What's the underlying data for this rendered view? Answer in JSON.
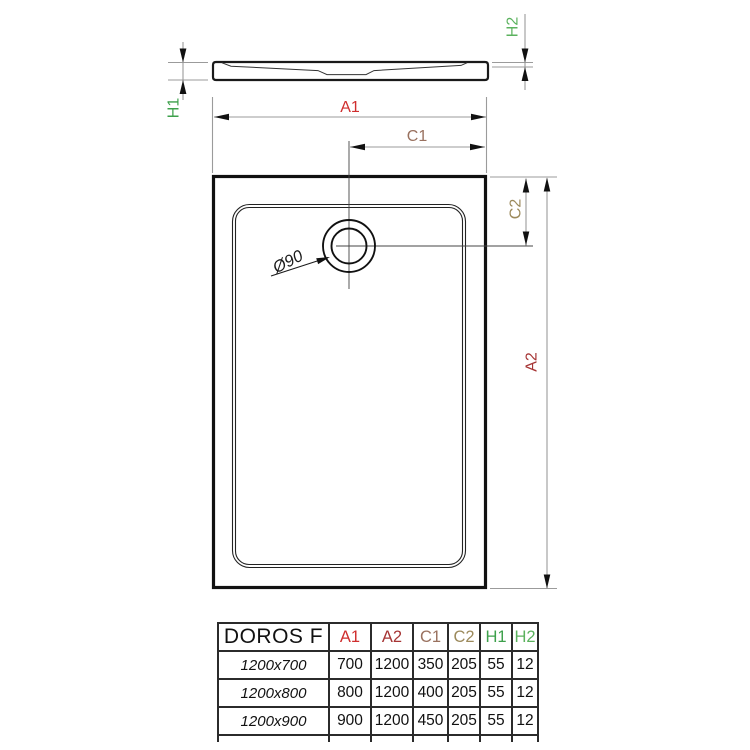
{
  "diagram": {
    "labels": {
      "a1": "A1",
      "a2": "A2",
      "c1": "C1",
      "c2": "C2",
      "h1": "H1",
      "h2": "H2",
      "drain_diameter": "Ø90"
    }
  },
  "colors": {
    "a1_red": "#cf2e2e",
    "a2_dark_red": "#a63535",
    "c1_brown": "#99715f",
    "c2_olive_brown": "#9c8a5c",
    "h1_green": "#3da04b",
    "h2_green": "#5bb25e",
    "drawing_line": "#1a1a1a",
    "dimension_gray": "#9b9b9b",
    "table_border": "#2b2b2b"
  },
  "table": {
    "product_name": "DOROS F",
    "columns": [
      "A1",
      "A2",
      "C1",
      "C2",
      "H1",
      "H2"
    ],
    "rows": [
      {
        "size": "1200x700",
        "values": [
          "700",
          "1200",
          "350",
          "205",
          "55",
          "12"
        ]
      },
      {
        "size": "1200x800",
        "values": [
          "800",
          "1200",
          "400",
          "205",
          "55",
          "12"
        ]
      },
      {
        "size": "1200x900",
        "values": [
          "900",
          "1200",
          "450",
          "205",
          "55",
          "12"
        ]
      }
    ]
  }
}
